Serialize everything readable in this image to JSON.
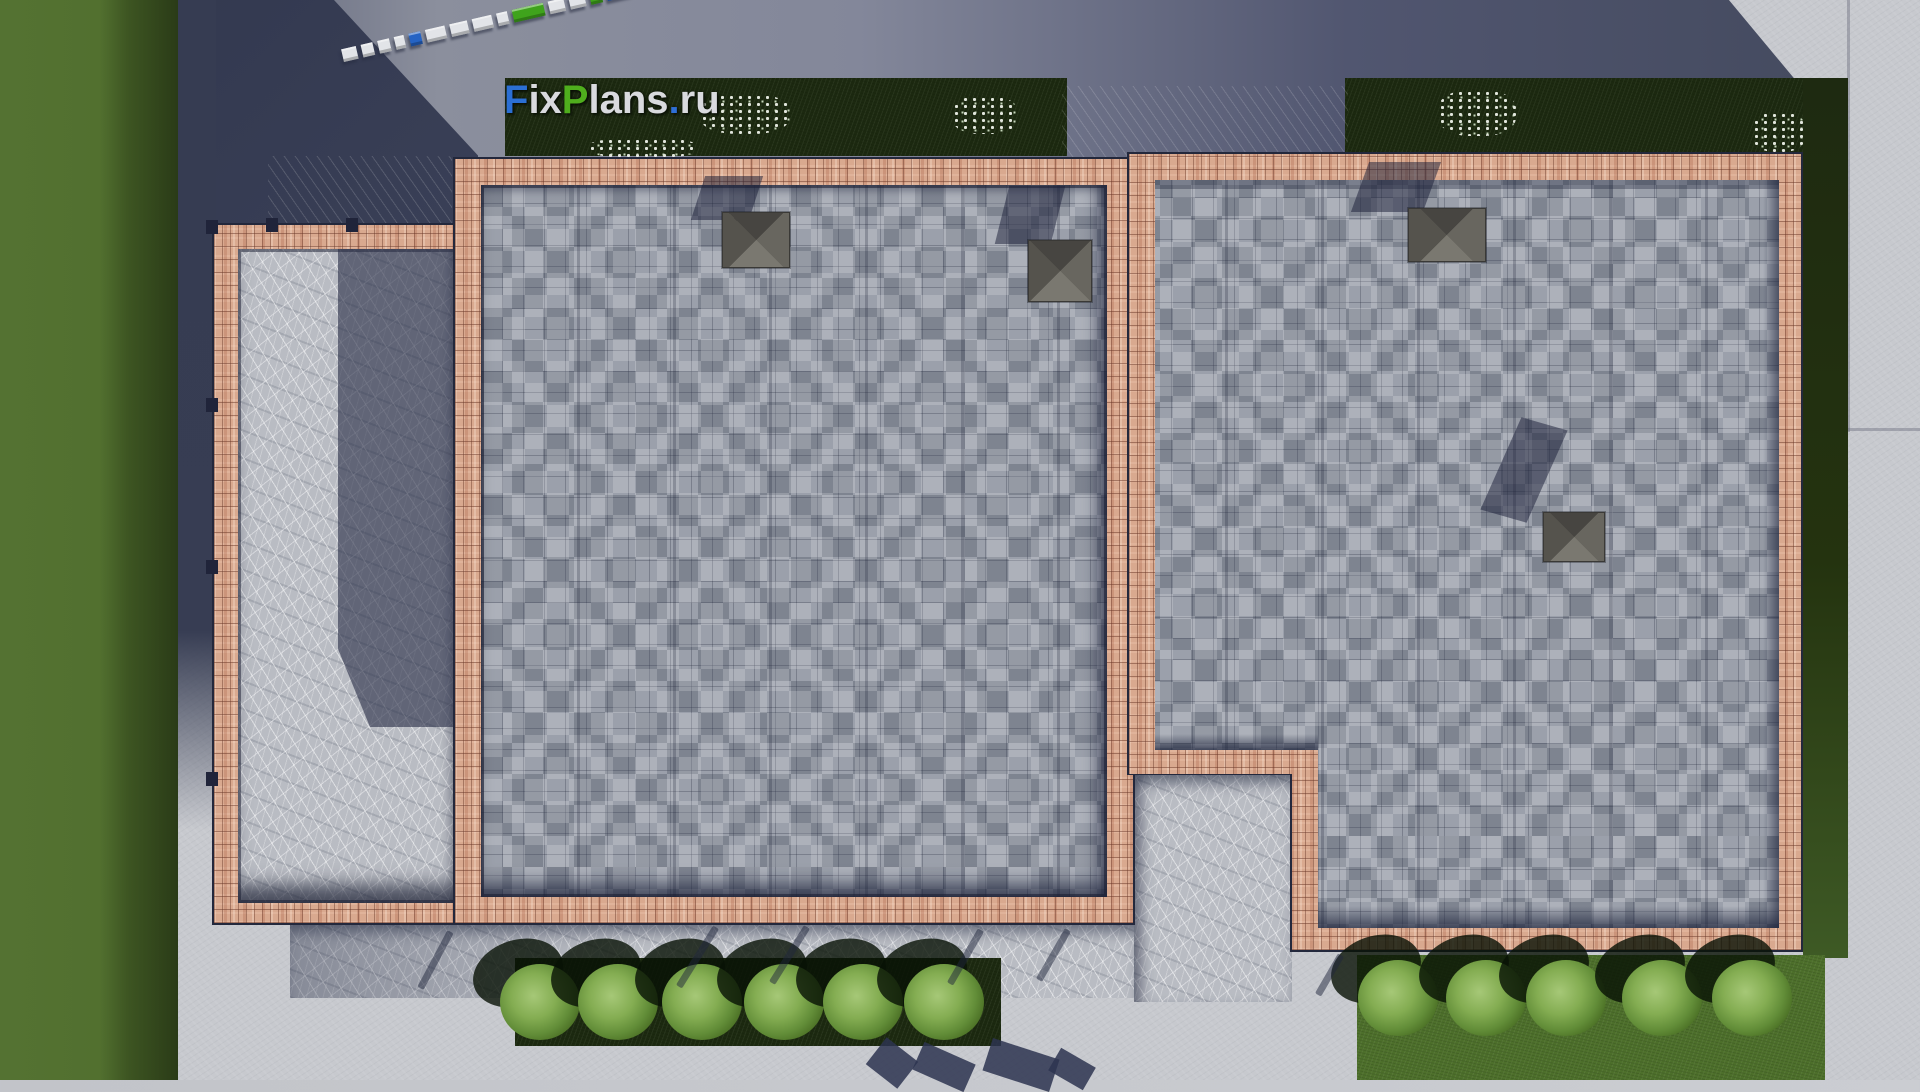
{
  "watermark": {
    "text": "FixPlans.ru",
    "segments": [
      {
        "text": "F",
        "color": "#2b6fd3"
      },
      {
        "text": "ix",
        "color": "#d9dade"
      },
      {
        "text": "P",
        "color": "#4fae1d"
      },
      {
        "text": "lans",
        "color": "#d9dade"
      },
      {
        "text": ".",
        "color": "#2f6fd6"
      },
      {
        "text": "ru",
        "color": "#d9dade"
      }
    ]
  },
  "scene": {
    "description": "Top-down 3D architectural render of a flat-roofed house: two shingled roof decks with pink brick parapets, a stone terrace, concrete walkways, lawns, hedges and round bushes",
    "logo_3d_blocks": [
      "white",
      "white",
      "white",
      "white",
      "blue",
      "white",
      "white",
      "white",
      "white",
      "green",
      "white",
      "white",
      "green",
      "blue"
    ],
    "palette": {
      "concrete": "#c7c9ce",
      "roof_shingles": "#9ba0ab",
      "brick_parapet": "#d9a98f",
      "stone_paving": "#b9bcc3",
      "lawn": "#547232",
      "hedge": "#1c2910",
      "cast_shadow": "#363c52",
      "logo_blue": "#2b6fd3",
      "logo_green": "#4fae1d"
    },
    "counts": {
      "roof_sections": 2,
      "chimney_vents": 4,
      "stair_flights": 2,
      "bottom_hedge_bushes": 6,
      "right_lawn_bushes": 5,
      "flower_clusters": 5
    }
  }
}
